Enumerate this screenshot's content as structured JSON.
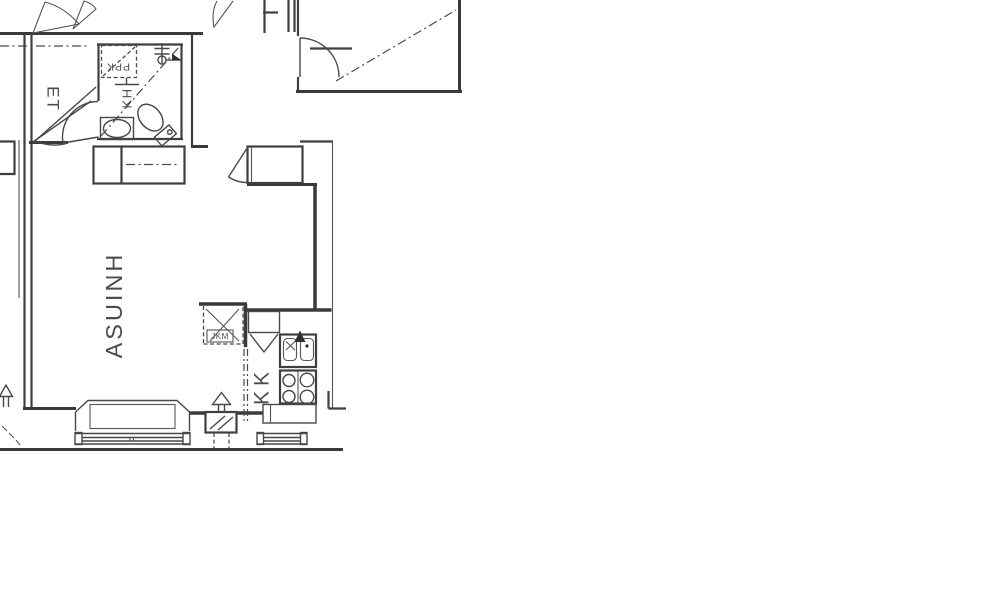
{
  "plan": {
    "type": "architectural-floor-plan",
    "rooms": {
      "living_room_label": "ASUINH",
      "entry_label": "ET",
      "bathroom_label": "KH",
      "kitchenette_label": "KK"
    },
    "appliances": {
      "washing_machine_label": "PPK",
      "fridge_label": "JKM"
    },
    "icons": {
      "toilet-icon": "tilted wc bowl with cistern",
      "washbasin-icon": "oval basin in counter",
      "shower-icon": "riser with ticks, head circle, black flag",
      "kitchen-sink-icon": "double basin, X mark, black faucet arrow",
      "stove-icon": "four burner circles with divider",
      "fridge-slot-icon": "dashed square with diagonals",
      "washing-machine-slot-icon": "dashed square with diagonal",
      "cooker-hood-icon": "triangle under cabinet",
      "ventilation-icon": "hatched box with hollow up arrow",
      "direction-arrow-icon": "hollow up arrow with dashes",
      "window-icon": "parallel line band with end caps",
      "door-swing-icon": "leaf line with quarter arc",
      "wardrobe-icon": "rectangle with dash-dot rail"
    },
    "colors": {
      "line": "#3a3a3a",
      "background": "#ffffff",
      "text": "#4c4c4c"
    }
  }
}
